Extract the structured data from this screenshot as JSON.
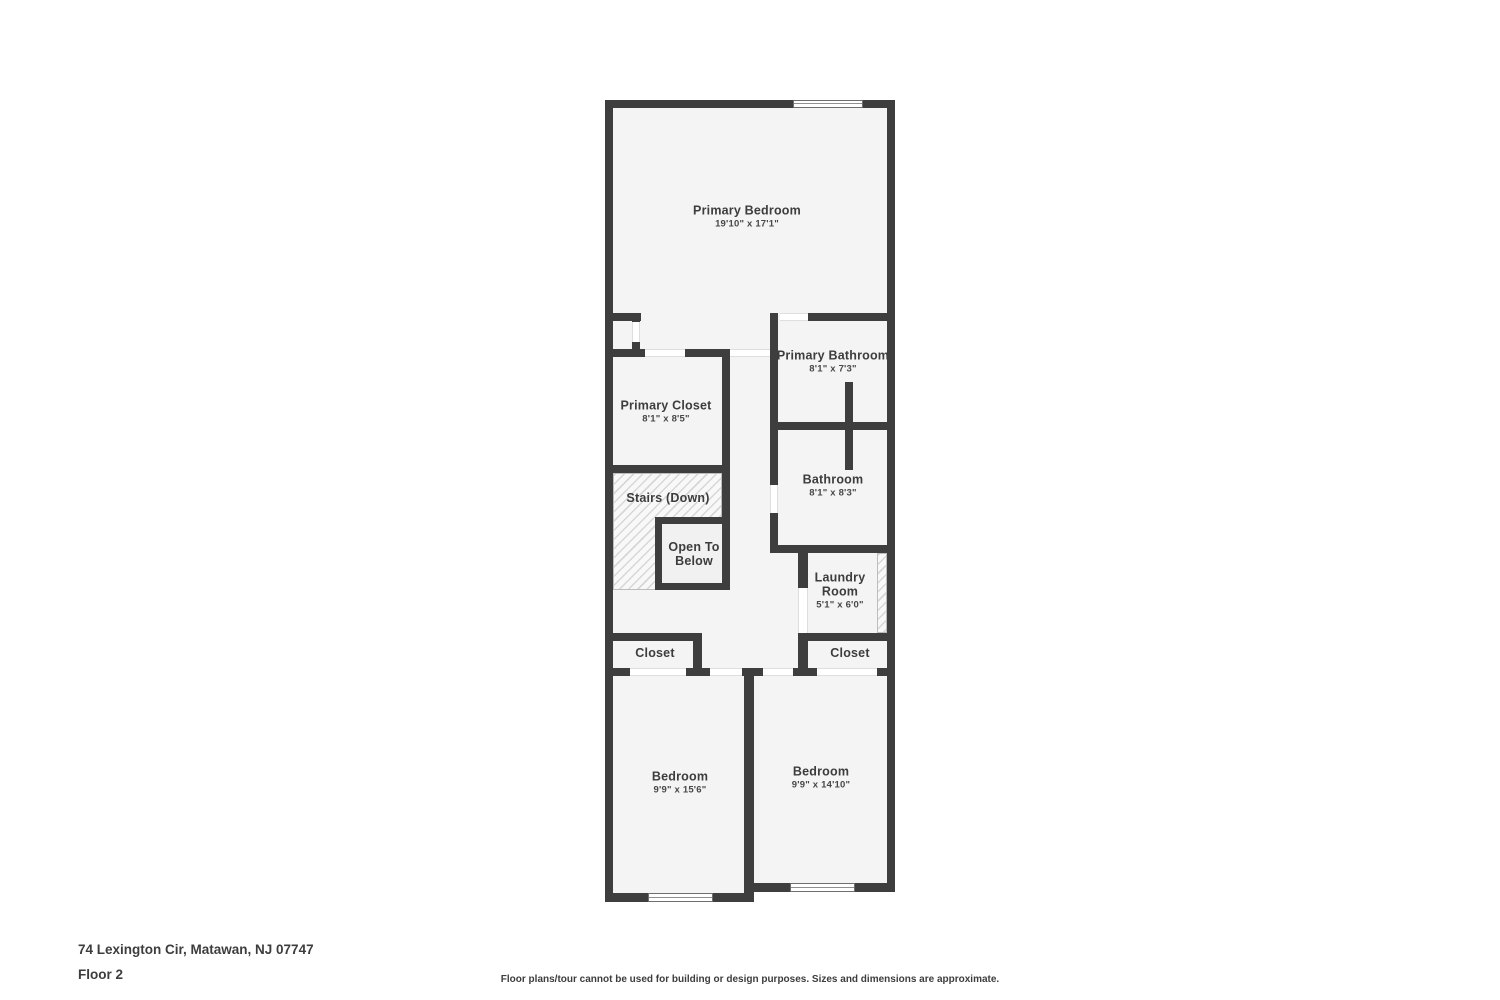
{
  "page": {
    "address": "74 Lexington Cir, Matawan, NJ 07747",
    "floor_label": "Floor 2",
    "disclaimer": "Floor plans/tour cannot be used for building or design purposes. Sizes and dimensions are approximate."
  },
  "colors": {
    "wall": "#3e3e3e",
    "floor": "#f4f4f4",
    "page_background": "#ffffff",
    "label_text": "#3d3d3d"
  },
  "floor_plan": {
    "floor": "Floor 2",
    "rooms": [
      {
        "name": "Primary Bedroom",
        "dimensions": "19'10\" x 17'1\""
      },
      {
        "name": "Primary Bathroom",
        "dimensions": "8'1\" x 7'3\""
      },
      {
        "name": "Primary Closet",
        "dimensions": "8'1\" x 8'5\""
      },
      {
        "name": "Bathroom",
        "dimensions": "8'1\" x 8'3\""
      },
      {
        "name": "Stairs (Down)",
        "dimensions": ""
      },
      {
        "name": "Open To Below",
        "dimensions": ""
      },
      {
        "name": "Laundry Room",
        "dimensions": "5'1\" x 6'0\""
      },
      {
        "name": "Closet",
        "dimensions": ""
      },
      {
        "name": "Closet",
        "dimensions": ""
      },
      {
        "name": "Bedroom",
        "dimensions": "9'9\" x 15'6\""
      },
      {
        "name": "Bedroom",
        "dimensions": "9'9\" x 14'10\""
      }
    ]
  }
}
